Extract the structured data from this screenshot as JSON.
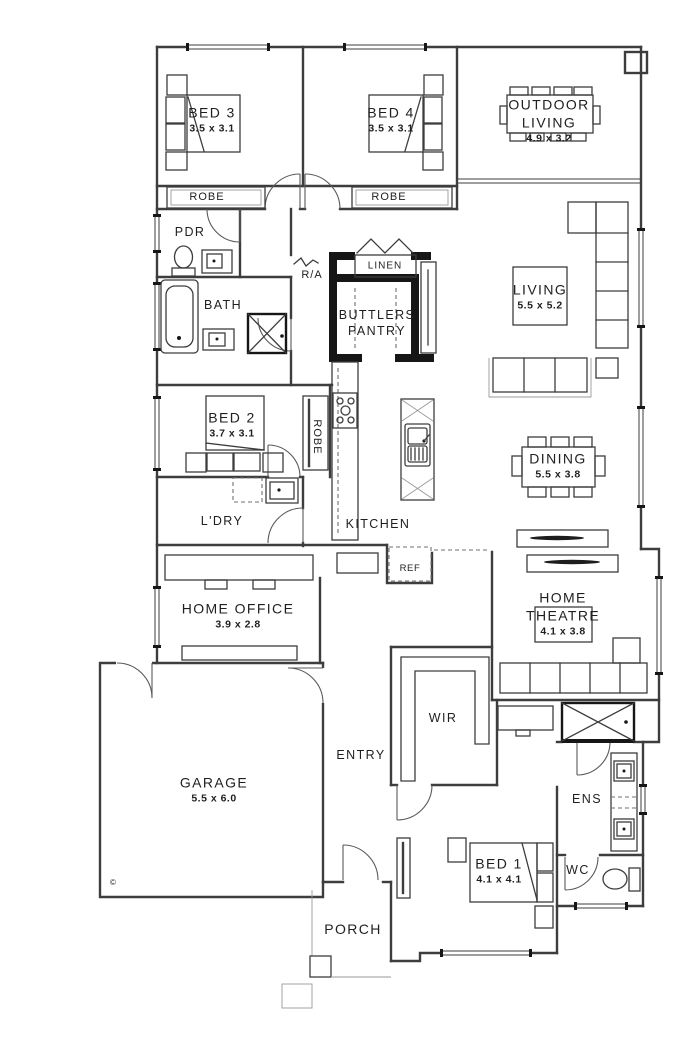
{
  "plan": {
    "rooms": {
      "bed3": {
        "name": "BED 3",
        "dims": "3.5 x 3.1"
      },
      "bed4": {
        "name": "BED 4",
        "dims": "3.5 x 3.1"
      },
      "outdoor_living": {
        "name": "OUTDOOR LIVING",
        "dims": "4.9 x 3.2"
      },
      "living": {
        "name": "LIVING",
        "dims": "5.5 x 5.2"
      },
      "dining": {
        "name": "DINING",
        "dims": "5.5 x 3.8"
      },
      "bed2": {
        "name": "BED 2",
        "dims": "3.7 x 3.1"
      },
      "home_office": {
        "name": "HOME OFFICE",
        "dims": "3.9 x 2.8"
      },
      "home_theatre": {
        "name": "HOME THEATRE",
        "dims": "4.1 x 3.8"
      },
      "garage": {
        "name": "GARAGE",
        "dims": "5.5 x 6.0"
      },
      "bed1": {
        "name": "BED 1",
        "dims": "4.1 x 4.1"
      },
      "kitchen": {
        "name": "KITCHEN"
      },
      "butlers_pantry": {
        "name": "BUTTLERS PANTRY"
      },
      "linen": {
        "name": "LINEN"
      },
      "pdr": {
        "name": "PDR"
      },
      "bath": {
        "name": "BATH"
      },
      "ldry": {
        "name": "L'DRY"
      },
      "entry": {
        "name": "ENTRY"
      },
      "wir": {
        "name": "WIR"
      },
      "ens": {
        "name": "ENS"
      },
      "wc": {
        "name": "WC"
      },
      "porch": {
        "name": "PORCH"
      },
      "robe_bed3": {
        "name": "ROBE"
      },
      "robe_bed4": {
        "name": "ROBE"
      },
      "robe_bed2": {
        "name": "ROBE"
      }
    },
    "annotations": {
      "return_air": "R/A",
      "fridge": "REF",
      "copyright": "©"
    },
    "colors": {
      "wall": "#3d3d3d",
      "thick_wall": "#161616",
      "background": "#ffffff"
    }
  }
}
